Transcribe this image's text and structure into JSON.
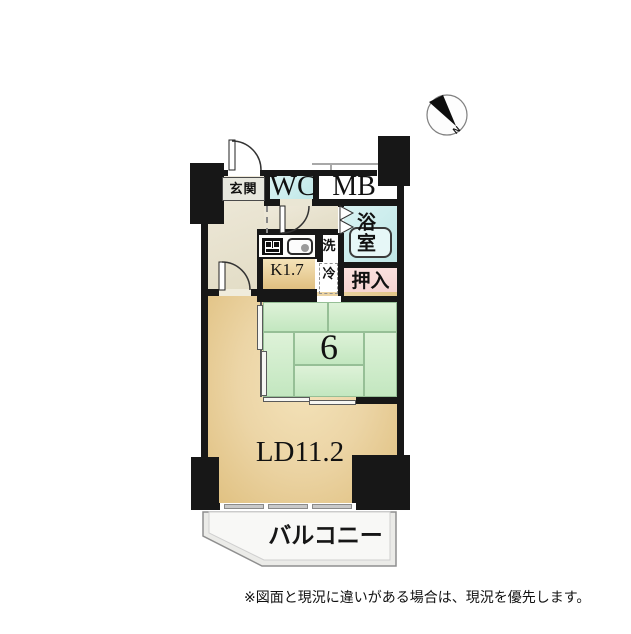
{
  "plan": {
    "rooms": {
      "genkan": "玄関",
      "wc": "WC",
      "mb": "MB",
      "bath": "浴室",
      "wash": "洗",
      "fridge": "冷",
      "kitchen": "K1.7",
      "closet": "押入",
      "tatami_size": "6",
      "living": "LD11.2",
      "balcony": "バルコニー"
    },
    "compass": {
      "north": "N"
    },
    "note": "※図面と現況に違いがある場合は、現況を優先します。",
    "colors": {
      "wall": "#171717",
      "hall_floor": "#eae5d3",
      "wet_area": "#c5ecec",
      "closet": "#f8dbd8",
      "tatami": "#cfeccb",
      "living_floor": "#ead1a2",
      "balcony": "#ebebe8"
    }
  }
}
